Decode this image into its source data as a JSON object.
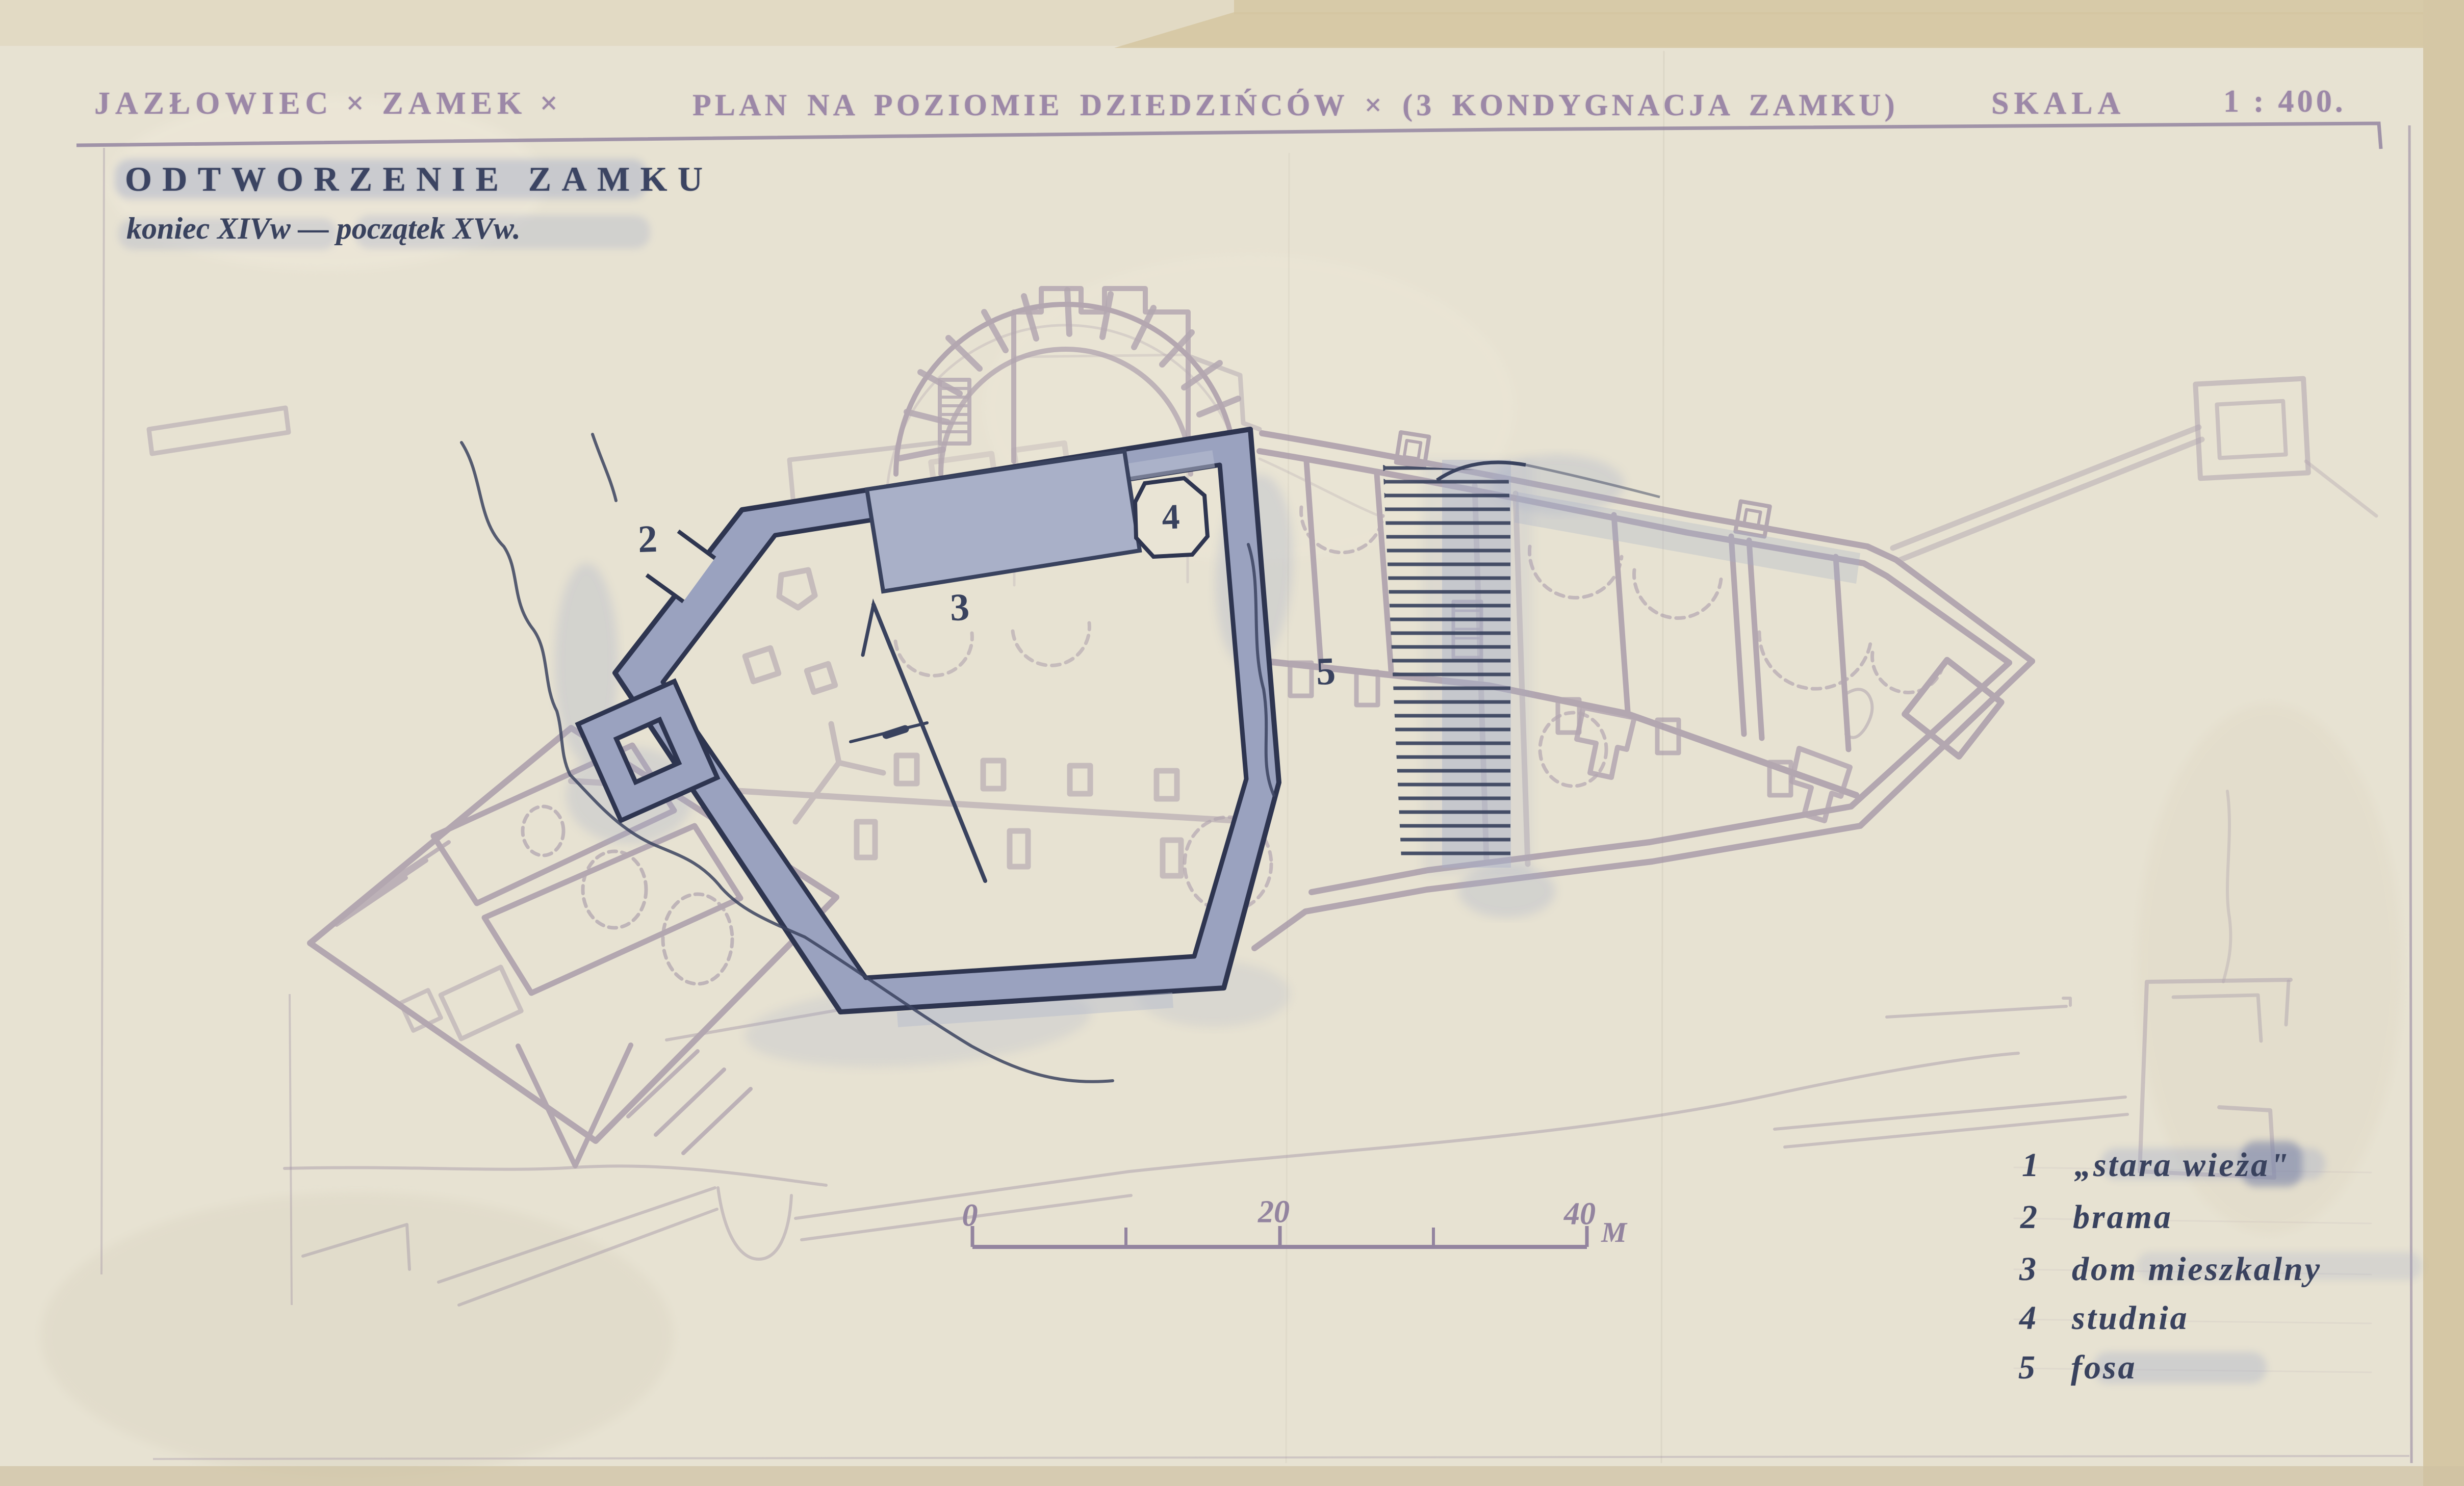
{
  "header": {
    "title_left": "JAZŁOWIEC × ZAMEK ×",
    "title_main": "PLAN NA POZIOMIE DZIEDZIŃCÓW × (3 KONDYGNACJA ZAMKU)",
    "scale_label": "SKALA",
    "scale_value": "1 : 400."
  },
  "subtitle": {
    "line1": "ODTWORZENIE ZAMKU",
    "line2": "koniec XIVw — początek XVw."
  },
  "plan": {
    "labels": {
      "gate": "2",
      "house": "3",
      "well": "4",
      "moat": "5"
    }
  },
  "scale_bar": {
    "tick0": "0",
    "tick20": "20",
    "tick40": "40",
    "unit": "M"
  },
  "legend": {
    "items": [
      {
        "num": "1",
        "label": "„stara wieża\""
      },
      {
        "num": "2",
        "label": "brama"
      },
      {
        "num": "3",
        "label": "dom mieszkalny"
      },
      {
        "num": "4",
        "label": "studnia"
      },
      {
        "num": "5",
        "label": "fosa"
      }
    ]
  },
  "colors": {
    "paper": "#e7e2d2",
    "ruin_line": "#a293a5",
    "wall_fill": "#9aa2bf",
    "wall_edge": "#2e3550",
    "ink": "#39425e",
    "stamp_purple": "#9c88a7",
    "wash": "#a6aec8"
  }
}
